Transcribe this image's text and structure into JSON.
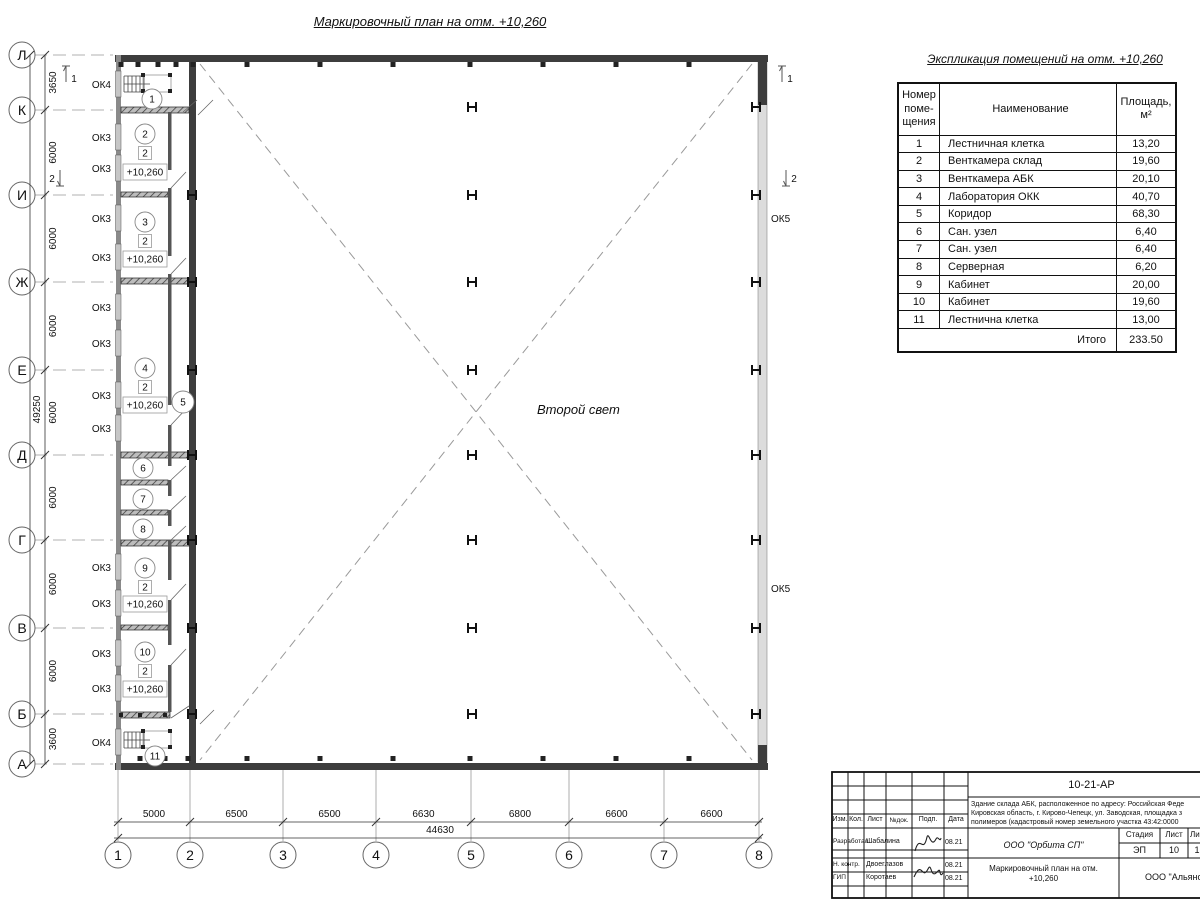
{
  "drawing": {
    "title": "Маркировочный план на отм. +10,260",
    "second_light": "Второй свет",
    "level_mark": "+10,260",
    "mezzanine_mark": "2"
  },
  "axes": {
    "cols": [
      {
        "n": "1",
        "x": 118
      },
      {
        "n": "2",
        "x": 190
      },
      {
        "n": "3",
        "x": 283
      },
      {
        "n": "4",
        "x": 376
      },
      {
        "n": "5",
        "x": 471
      },
      {
        "n": "6",
        "x": 569
      },
      {
        "n": "7",
        "x": 664
      },
      {
        "n": "8",
        "x": 759
      }
    ],
    "rows": [
      {
        "n": "Л",
        "y": 55
      },
      {
        "n": "К",
        "y": 110
      },
      {
        "n": "И",
        "y": 195
      },
      {
        "n": "Ж",
        "y": 282
      },
      {
        "n": "Е",
        "y": 370
      },
      {
        "n": "Д",
        "y": 455
      },
      {
        "n": "Г",
        "y": 540
      },
      {
        "n": "В",
        "y": 628
      },
      {
        "n": "Б",
        "y": 714
      },
      {
        "n": "А",
        "y": 764
      }
    ],
    "col_dims": [
      "5000",
      "6500",
      "6500",
      "6630",
      "6800",
      "6600",
      "6600"
    ],
    "col_total": "44630",
    "row_dims": [
      "3650",
      "6000",
      "6000",
      "6000",
      "6000",
      "6000",
      "6000",
      "6000",
      "3600"
    ],
    "row_total": "49250",
    "section_marks": [
      {
        "n": "1",
        "x": 66,
        "y": 66,
        "dir": "up",
        "tx": 74,
        "ty": 82
      },
      {
        "n": "1",
        "x": 782,
        "y": 66,
        "dir": "up",
        "tx": 790,
        "ty": 82
      },
      {
        "n": "2",
        "x": 60,
        "y": 170,
        "dir": "down",
        "tx": 52,
        "ty": 182
      },
      {
        "n": "2",
        "x": 786,
        "y": 170,
        "dir": "down",
        "tx": 794,
        "ty": 182
      }
    ]
  },
  "openings": {
    "left": [
      {
        "l": "ОК4",
        "y": 84
      },
      {
        "l": "ОК3",
        "y": 137
      },
      {
        "l": "ОК3",
        "y": 168
      },
      {
        "l": "ОК3",
        "y": 218
      },
      {
        "l": "ОК3",
        "y": 257
      },
      {
        "l": "ОК3",
        "y": 307
      },
      {
        "l": "ОК3",
        "y": 343
      },
      {
        "l": "ОК3",
        "y": 395
      },
      {
        "l": "ОК3",
        "y": 428
      },
      {
        "l": "ОК3",
        "y": 567
      },
      {
        "l": "ОК3",
        "y": 603
      },
      {
        "l": "ОК3",
        "y": 653
      },
      {
        "l": "ОК3",
        "y": 688
      },
      {
        "l": "ОК4",
        "y": 742
      }
    ],
    "right": [
      {
        "l": "ОК5",
        "y": 218
      },
      {
        "l": "ОК5",
        "y": 588
      }
    ]
  },
  "rooms": [
    {
      "n": "1",
      "cx": 152,
      "cy": 99
    },
    {
      "n": "2",
      "cx": 145,
      "cy": 134,
      "sq": 153,
      "lvl": 172
    },
    {
      "n": "3",
      "cx": 145,
      "cy": 222,
      "sq": 241,
      "lvl": 259
    },
    {
      "n": "4",
      "cx": 145,
      "cy": 368,
      "sq": 387,
      "lvl": 405
    },
    {
      "n": "5",
      "cx": 183,
      "cy": 402
    },
    {
      "n": "6",
      "cx": 143,
      "cy": 468
    },
    {
      "n": "7",
      "cx": 143,
      "cy": 499
    },
    {
      "n": "8",
      "cx": 143,
      "cy": 529
    },
    {
      "n": "9",
      "cx": 145,
      "cy": 568,
      "sq": 587,
      "lvl": 604
    },
    {
      "n": "10",
      "cx": 145,
      "cy": 652,
      "sq": 671,
      "lvl": 689
    },
    {
      "n": "11",
      "cx": 155,
      "cy": 756
    }
  ],
  "table": {
    "title": "Экспликация помещений на отм. +10,260",
    "headers": {
      "num": "Номер\nпоме-\nщения",
      "name": "Наименование",
      "area": "Площадь,\nм²"
    },
    "rows": [
      {
        "num": "1",
        "name": "Лестничная клетка",
        "area": "13,20"
      },
      {
        "num": "2",
        "name": "Венткамера склад",
        "area": "19,60"
      },
      {
        "num": "3",
        "name": "Венткамера АБК",
        "area": "20,10"
      },
      {
        "num": "4",
        "name": "Лаборатория ОКК",
        "area": "40,70"
      },
      {
        "num": "5",
        "name": "Коридор",
        "area": "68,30"
      },
      {
        "num": "6",
        "name": "Сан. узел",
        "area": "6,40"
      },
      {
        "num": "7",
        "name": "Сан. узел",
        "area": "6,40"
      },
      {
        "num": "8",
        "name": "Серверная",
        "area": "6,20"
      },
      {
        "num": "9",
        "name": "Кабинет",
        "area": "20,00"
      },
      {
        "num": "10",
        "name": "Кабинет",
        "area": "19,60"
      },
      {
        "num": "11",
        "name": "Лестнична клетка",
        "area": "13,00"
      }
    ],
    "total_label": "Итого",
    "total_value": "233.50"
  },
  "title_block": {
    "doc_number": "10-21-АР",
    "description_lines": [
      "Здание склада АБК, расположенное по адресу: Российская Феде",
      "Кировская область, г. Кирово-Чепецк, ул. Заводская, площадка з",
      "полимеров (кадастровый номер земельного участка 43:42:0000"
    ],
    "stamp_headers": [
      "Изм.",
      "Кол.",
      "Лист",
      "№док.",
      "Подп.",
      "Дата"
    ],
    "people": [
      {
        "role": "Разработал",
        "name": "Шабалина",
        "date": "08.21"
      },
      {
        "role": "Н. контр.",
        "name": "Двоеглазов",
        "date": "08.21"
      },
      {
        "role": "ГИП",
        "name": "Коротаев",
        "date": "08.21"
      }
    ],
    "org1": "ООО \"Орбита СП\"",
    "stage_label": "Стадия",
    "sheet_label": "Лист",
    "sheets_label": "Листов",
    "stage": "ЭП",
    "sheet": "10",
    "sheets": "1",
    "sheet_title": "Маркировочный план на отм.\n+10,260",
    "org2": "ООО \"Альянс"
  }
}
